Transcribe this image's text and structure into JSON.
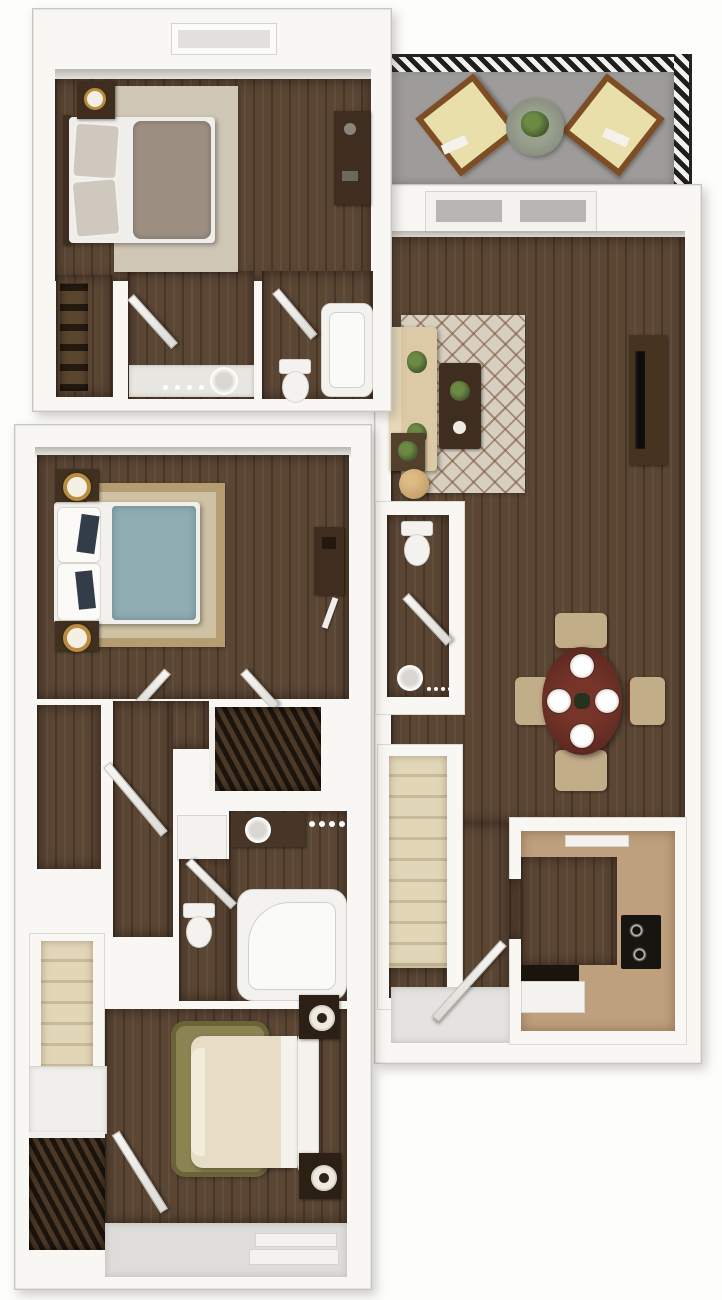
{
  "meta": {
    "type": "3d-floor-plan",
    "description": "Top-down 3D rendered floor plan of a two-level apartment: upper bedroom suite with balcony and open living/dining/kitchen level, plus a second bedroom level with two bedrooms, bathroom and stairs",
    "canvas": {
      "width": 722,
      "height": 1300
    }
  },
  "palette": {
    "wall": "#f8f7f4",
    "wallEdge": "#c9c6c0",
    "wood": "#5b4634",
    "woodDk": "#3f2e1f",
    "balcony": "#9d9c9a",
    "stair": "#e2d6b8",
    "stairLine": "#c9bb98",
    "counter": "#bfa07e",
    "rugCream": "#d7d0c1",
    "lattice": "#8a6850",
    "rugTan": "#cfc1a3",
    "rugTanBd": "#b59d71",
    "rugOlive": "#8b8352",
    "taupe": "#9c8f82",
    "teal": "#8fadb2",
    "cream": "#e7ddc7",
    "sofa": "#dcc9a5",
    "tableRed": "#5f2a21",
    "chair": "#c2ad89",
    "fixture": "#f3f2ef",
    "plant": "#4c6233",
    "gold": "#b98c3e",
    "black": "#17150f"
  },
  "labels": {
    "bedroom_upper": "bedroom (upper suite)",
    "closet_upper": "closet",
    "hall_upper": "hall with vanity",
    "bath_upper": "bathroom",
    "balcony": "balcony / patio",
    "entry": "entry",
    "living": "living room",
    "powder": "half bathroom",
    "dining": "dining area",
    "stairs_main": "staircase",
    "kitchen": "kitchen",
    "master": "master bedroom",
    "closet_walkin": "walk-in closet",
    "closet_hall": "hall closet",
    "bath_lower": "bathroom with garden tub",
    "stairs_lower": "staircase",
    "bedroom2": "bedroom 2",
    "closet2": "bedroom 2 closet"
  },
  "units": [
    {
      "name": "upper-bedroom-suite",
      "rooms": [
        {
          "name": "bedroom",
          "furniture": [
            "queen-bed",
            "area-rug",
            "nightstand-with-clock",
            "dresser",
            "window"
          ]
        },
        {
          "name": "closet",
          "furniture": [
            "shelving"
          ]
        },
        {
          "name": "hall",
          "furniture": [
            "vanity-sink",
            "door-swing"
          ]
        },
        {
          "name": "bathroom",
          "furniture": [
            "bathtub",
            "toilet",
            "door-swing"
          ]
        }
      ]
    },
    {
      "name": "balcony",
      "furniture": [
        "railing",
        "lounge-chair",
        "lounge-chair",
        "patio-table-with-plant"
      ]
    },
    {
      "name": "main-living-level",
      "rooms": [
        {
          "name": "entry",
          "furniture": [
            "front-door-with-sidelites",
            "door-swing"
          ]
        },
        {
          "name": "living-room",
          "furniture": [
            "sofa-with-pillows",
            "lattice-area-rug",
            "coffee-table-with-plant",
            "media-console-with-tv",
            "side-table-plant",
            "round-ottoman"
          ]
        },
        {
          "name": "half-bathroom",
          "furniture": [
            "toilet",
            "vanity-sink",
            "door-swing"
          ]
        },
        {
          "name": "dining-area",
          "furniture": [
            "round-table",
            "place-setting",
            "place-setting",
            "place-setting",
            "place-setting",
            "chair",
            "chair",
            "chair",
            "chair"
          ]
        },
        {
          "name": "staircase",
          "furniture": [
            "stairs"
          ]
        },
        {
          "name": "kitchen",
          "furniture": [
            "u-shaped-counter",
            "range-hood-vent",
            "cooktop",
            "oven",
            "dishwasher"
          ]
        }
      ]
    },
    {
      "name": "lower-bedroom-level",
      "rooms": [
        {
          "name": "master-bedroom",
          "furniture": [
            "teal-bed",
            "bordered-area-rug",
            "nightstand-lamp",
            "nightstand-lamp",
            "desk",
            "door-swing",
            "door-swing"
          ]
        },
        {
          "name": "walk-in-closet",
          "furniture": [
            "door-swing"
          ]
        },
        {
          "name": "hall-closet",
          "furniture": [
            "hanging-clothes"
          ]
        },
        {
          "name": "bathroom",
          "furniture": [
            "vanity-sink",
            "mirror-lights",
            "linen-cabinet",
            "toilet",
            "garden-tub",
            "door-swing"
          ]
        },
        {
          "name": "staircase",
          "furniture": [
            "stairs"
          ]
        },
        {
          "name": "bedroom-2",
          "furniture": [
            "cream-bed",
            "shag-rug",
            "nightstand-lamp",
            "nightstand-lamp",
            "closet-hanging-clothes",
            "window-bay"
          ]
        }
      ]
    }
  ]
}
